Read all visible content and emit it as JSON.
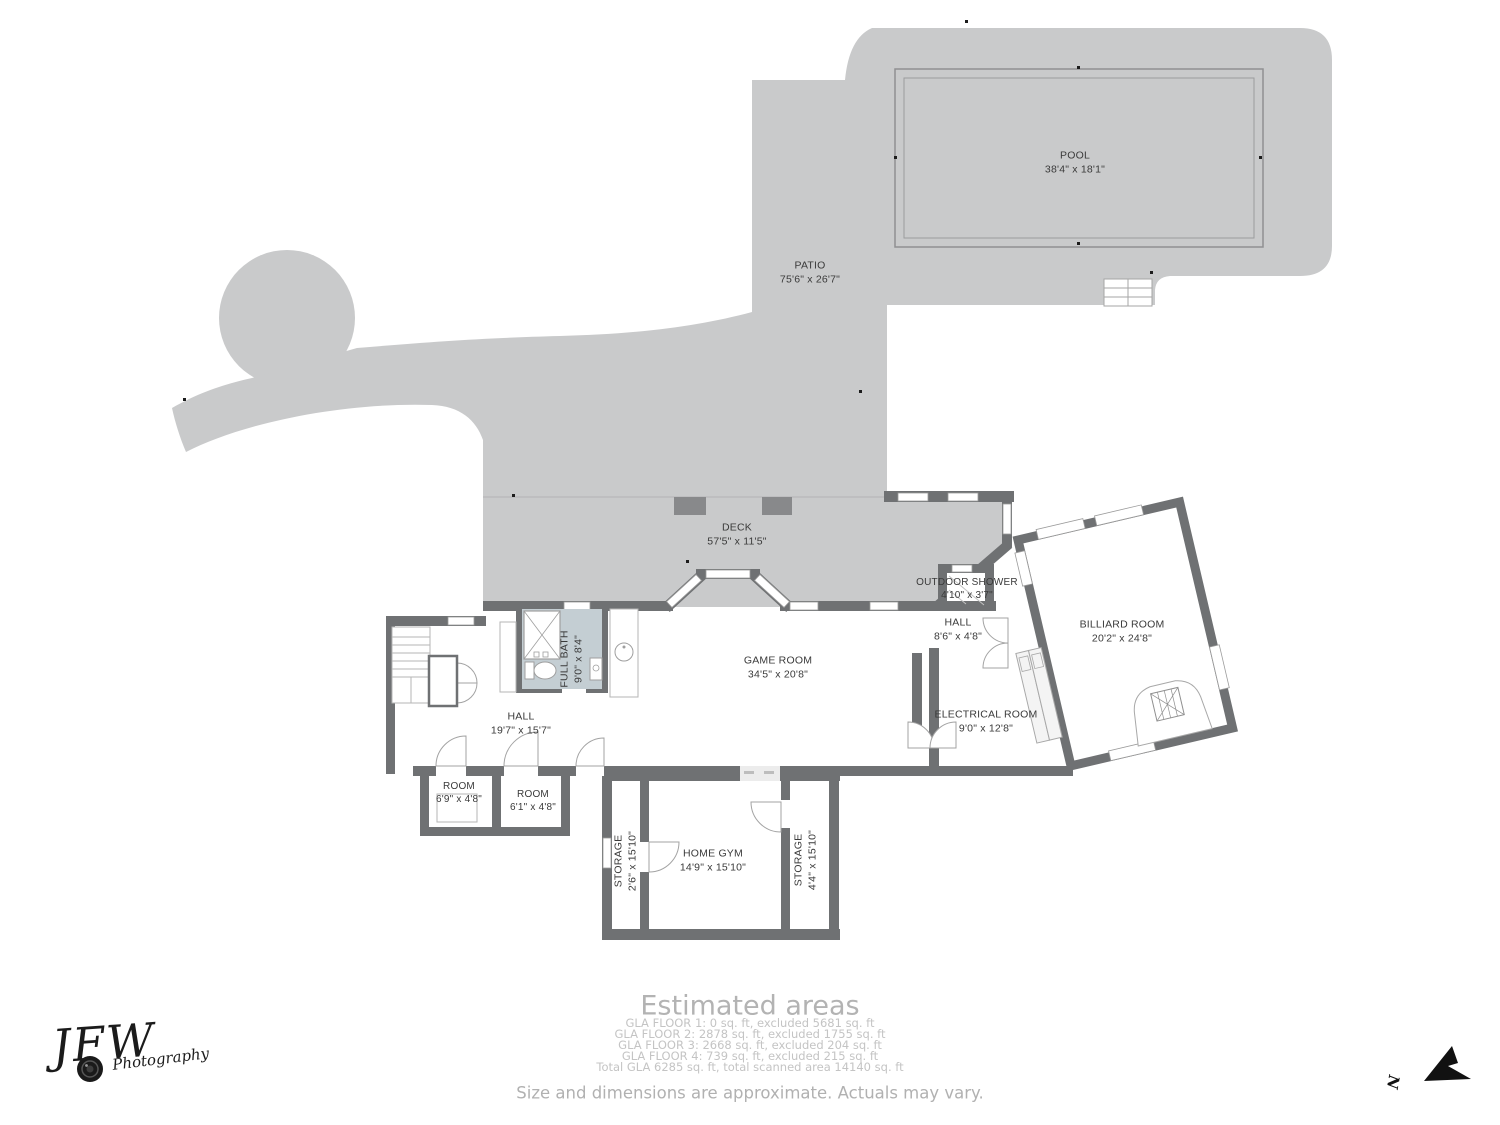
{
  "rooms": {
    "pool": {
      "name": "POOL",
      "dims": "38'4\" x 18'1\""
    },
    "patio": {
      "name": "PATIO",
      "dims": "75'6\" x 26'7\""
    },
    "deck": {
      "name": "DECK",
      "dims": "57'5\" x 11'5\""
    },
    "outdoor_shower": {
      "name": "OUTDOOR SHOWER",
      "dims": "4'10\" x 3'7\""
    },
    "hall_small": {
      "name": "HALL",
      "dims": "8'6\" x 4'8\""
    },
    "billiard": {
      "name": "BILLIARD ROOM",
      "dims": "20'2\" x 24'8\""
    },
    "game_room": {
      "name": "GAME ROOM",
      "dims": "34'5\" x 20'8\""
    },
    "full_bath": {
      "name": "FULL BATH",
      "dims": "9'0\" x 8'4\""
    },
    "electrical": {
      "name": "ELECTRICAL ROOM",
      "dims": "9'0\" x 12'8\""
    },
    "hall_big": {
      "name": "HALL",
      "dims": "19'7\" x 15'7\""
    },
    "room_a": {
      "name": "ROOM",
      "dims": "6'9\" x 4'8\""
    },
    "room_b": {
      "name": "ROOM",
      "dims": "6'1\" x 4'8\""
    },
    "storage_left": {
      "name": "STORAGE",
      "dims": "2'6\" x 15'10\""
    },
    "home_gym": {
      "name": "HOME GYM",
      "dims": "14'9\" x 15'10\""
    },
    "storage_right": {
      "name": "STORAGE",
      "dims": "4'4\" x 15'10\""
    }
  },
  "footer": {
    "title": "Estimated areas",
    "lines": [
      "GLA FLOOR 1: 0 sq. ft, excluded 5681 sq. ft",
      "GLA FLOOR 2: 2878 sq. ft, excluded 1755 sq. ft",
      "GLA FLOOR 3: 2668 sq. ft, excluded 204 sq. ft",
      "GLA FLOOR 4: 739 sq. ft, excluded 215 sq. ft",
      "Total GLA 6285 sq. ft, total scanned area 14140 sq. ft"
    ],
    "disclaimer": "Size and dimensions are approximate. Actuals may vary."
  },
  "logo": {
    "initials": "JFW",
    "word": "Photography"
  },
  "compass": {
    "north": "N"
  },
  "colors": {
    "surface": "#c9cacb",
    "wall": "#6f7173",
    "bath": "#c4ced3",
    "planter": "#88898b"
  }
}
